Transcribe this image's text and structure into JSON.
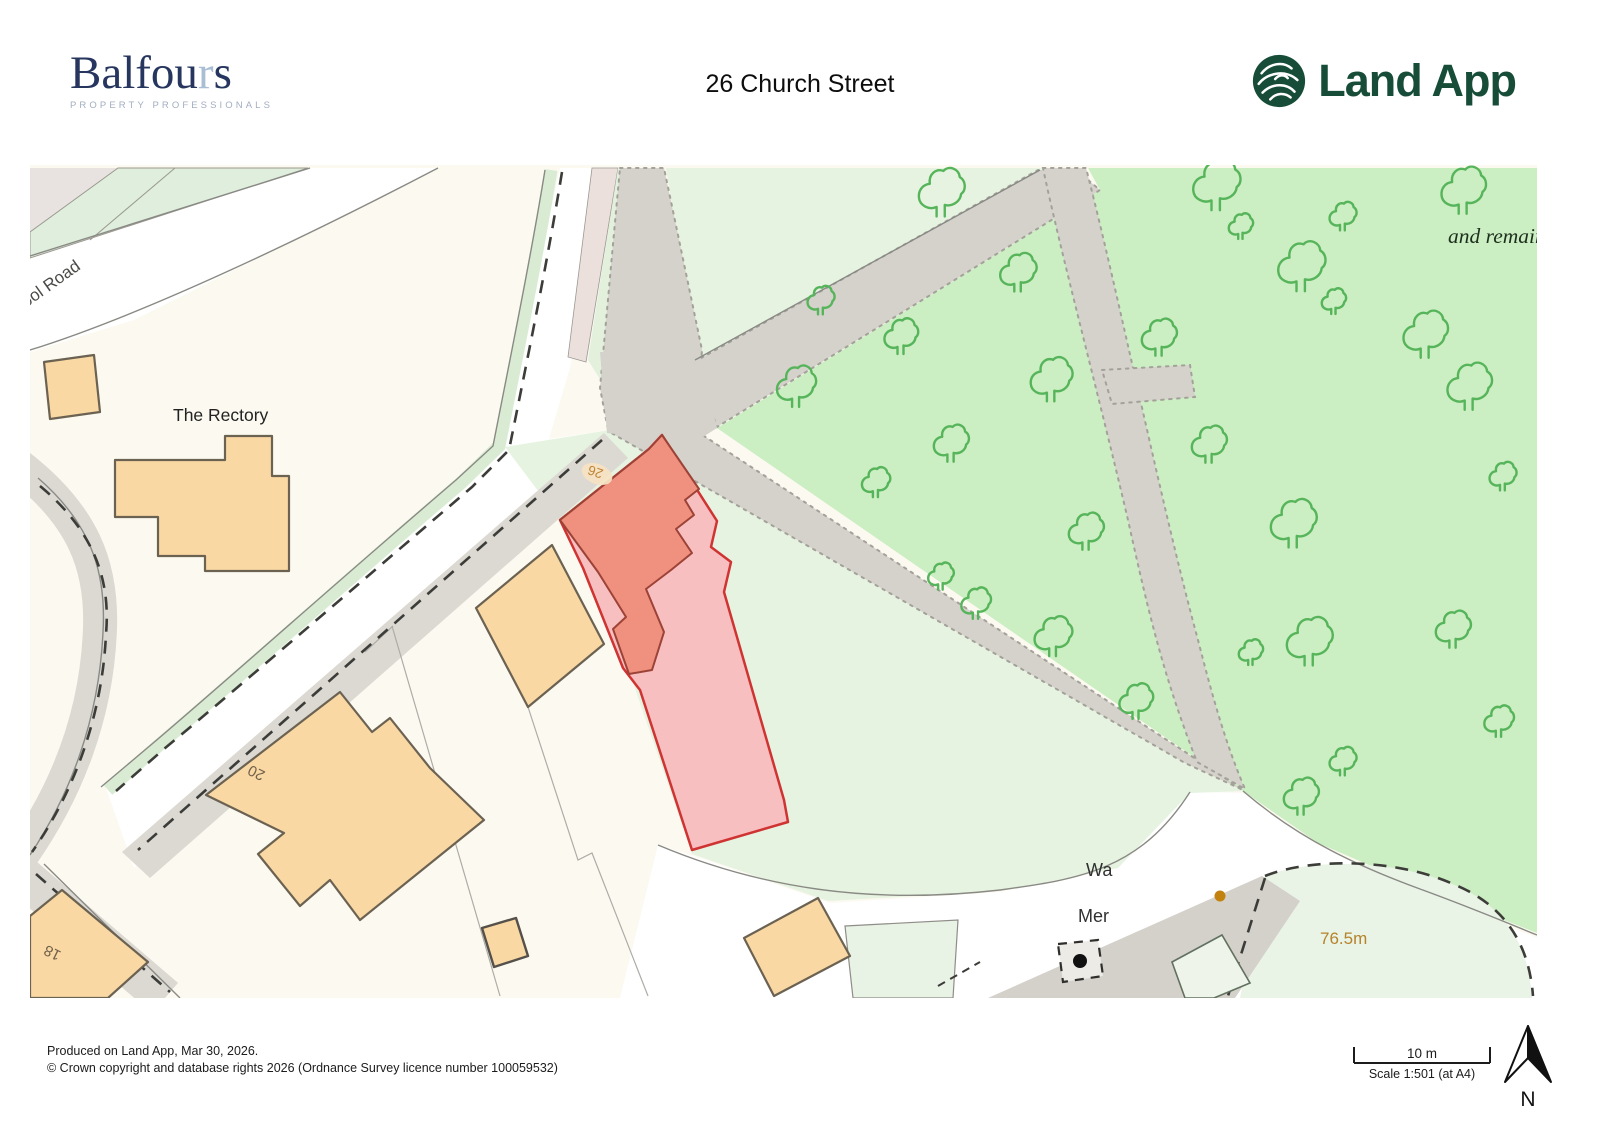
{
  "header": {
    "balfours": {
      "name_prefix": "Balfou",
      "name_r": "r",
      "name_suffix": "s",
      "subtitle": "PROPERTY PROFESSIONALS"
    },
    "title": "26 Church Street",
    "landapp": {
      "name": "Land App"
    }
  },
  "map": {
    "labels": {
      "road_partial": "ool Road",
      "rectory": "The Rectory",
      "house_20": "20",
      "house_18": "18",
      "plot_26": "26",
      "wa_partial": "Wa",
      "mer_partial": "Mer",
      "spot_height": "76.5m",
      "antiquity_partial": "and remain"
    },
    "colors": {
      "selection_outline": "#cf3332",
      "selection_fill": "#f8bfc1",
      "selected_building": "#f0917f",
      "building_tan": "#f9d8a4",
      "woodland_green": "#cbeec2",
      "tree_outline": "#56b45a",
      "path_grey": "#d5d2cc",
      "light_green": "#e6f3e1",
      "spot_height_color": "#b5832a"
    }
  },
  "scalebar": {
    "distance": "10 m",
    "scale": "Scale 1:501 (at A4)"
  },
  "compass": {
    "north": "N"
  },
  "footer": {
    "line1": "Produced on Land App, Mar 30, 2026.",
    "line2": "© Crown copyright and database rights 2026 (Ordnance Survey licence number 100059532)"
  }
}
